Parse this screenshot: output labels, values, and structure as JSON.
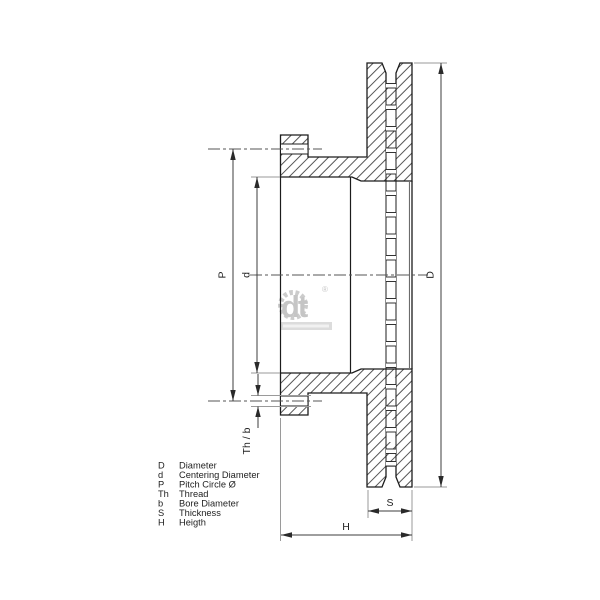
{
  "dims": {
    "D": "D",
    "d": "d",
    "P": "P",
    "th_b": "Th / b",
    "S": "S",
    "H": "H"
  },
  "legend": [
    {
      "key": "D",
      "label": "Diameter"
    },
    {
      "key": "d",
      "label": "Centering Diameter"
    },
    {
      "key": "P",
      "label": "Pitch Circle Ø"
    },
    {
      "key": "Th",
      "label": "Thread"
    },
    {
      "key": "b",
      "label": "Bore Diameter"
    },
    {
      "key": "S",
      "label": "Thickness"
    },
    {
      "key": "H",
      "label": "Heigth"
    }
  ],
  "logo": {
    "text": "dt",
    "reg": "®"
  },
  "colors": {
    "outline": "#1c1c1c",
    "dimension": "#3c3c3c",
    "extension": "#9a9a9a",
    "watermark": "#bcbcbc",
    "background": "#ffffff"
  }
}
